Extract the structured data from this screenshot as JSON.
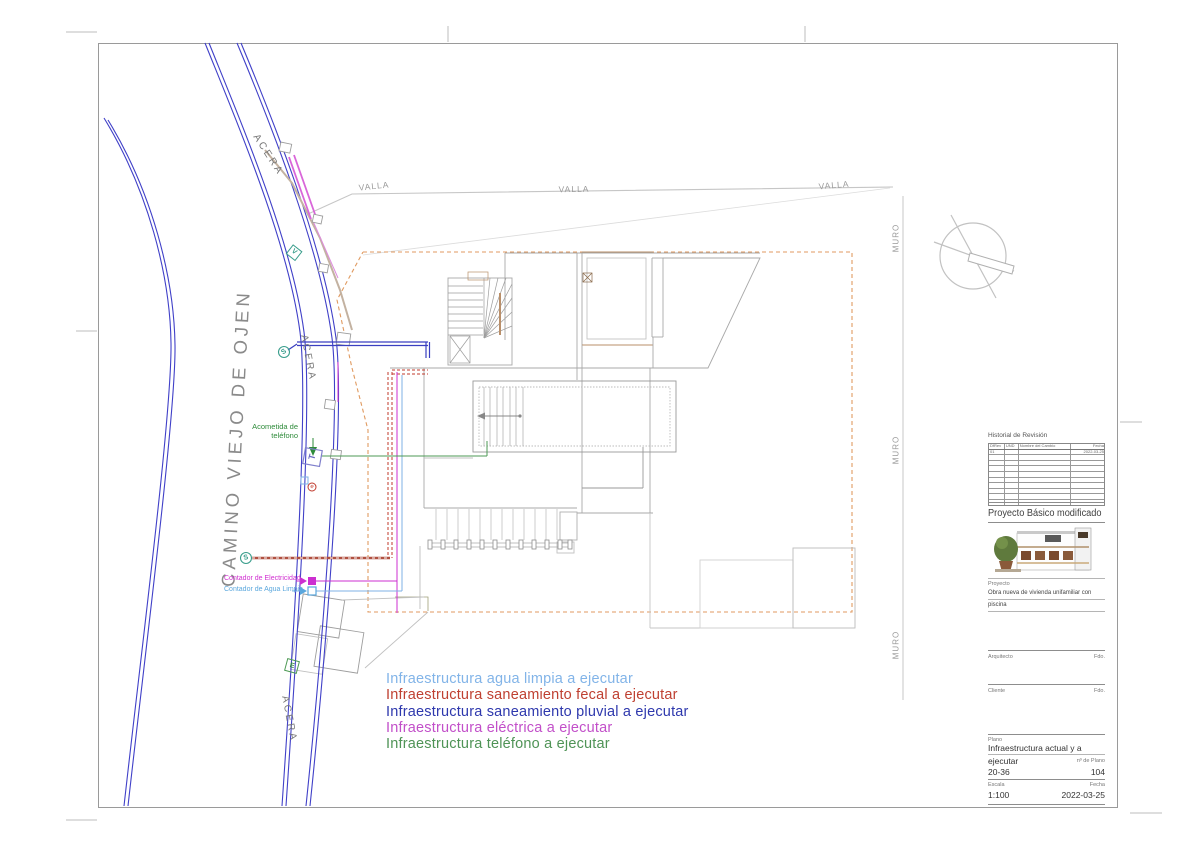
{
  "drawing": {
    "street_name": "CAMINO VIEJO DE OJEN",
    "sidewalk_label": "ACERA",
    "fence_label": "VALLA",
    "wall_label": "MURO",
    "acometida_line1": "Acometida de",
    "acometida_line2": "teléfono",
    "contador_electricidad": "Contador de Electricidad",
    "contador_agua": "Contador de Agua Limpia",
    "symbol_s": "S",
    "symbol_t": "T",
    "symbol_v": "V",
    "symbol_e": "E",
    "symbol_e_small": "e"
  },
  "legend": {
    "items": [
      {
        "label": "Infraestructura agua limpia a ejecutar",
        "color": "#82b4e8"
      },
      {
        "label": "Infraestructura saneamiento fecal a ejecutar",
        "color": "#bf4031"
      },
      {
        "label": "Infraestructura saneamiento pluvial a ejecutar",
        "color": "#2e38ad"
      },
      {
        "label": "Infraestructura eléctrica a ejecutar",
        "color": "#c24fc9"
      },
      {
        "label": "Infraestructura teléfono a ejecutar",
        "color": "#4f9356"
      }
    ]
  },
  "titleblock": {
    "revision": {
      "title": "Historial de Revisión",
      "columns": [
        "DfRev",
        "UND",
        "Nombre del Cambio",
        "Fecha"
      ],
      "first_row_rev": "01",
      "first_row_fecha": "2022-03-25"
    },
    "project_title": "Proyecto Básico modificado",
    "project_label": "Proyecto",
    "project_desc_line1": "Obra nueva de vivienda unifamiliar con",
    "project_desc_line2": "piscina",
    "arquitecto_label": "Arquitecto",
    "cliente_label": "Cliente",
    "fdo_label": "Fdo.",
    "plano_label": "Plano",
    "plano_title_line1": "Infraestructura actual y a",
    "plano_title_line2": "ejecutar",
    "expediente": "20-36",
    "num_plano_label": "nº de Plano",
    "num_plano": "104",
    "escala_label": "Escala",
    "escala": "1:100",
    "fecha_label": "Fecha",
    "fecha": "2022-03-25"
  }
}
